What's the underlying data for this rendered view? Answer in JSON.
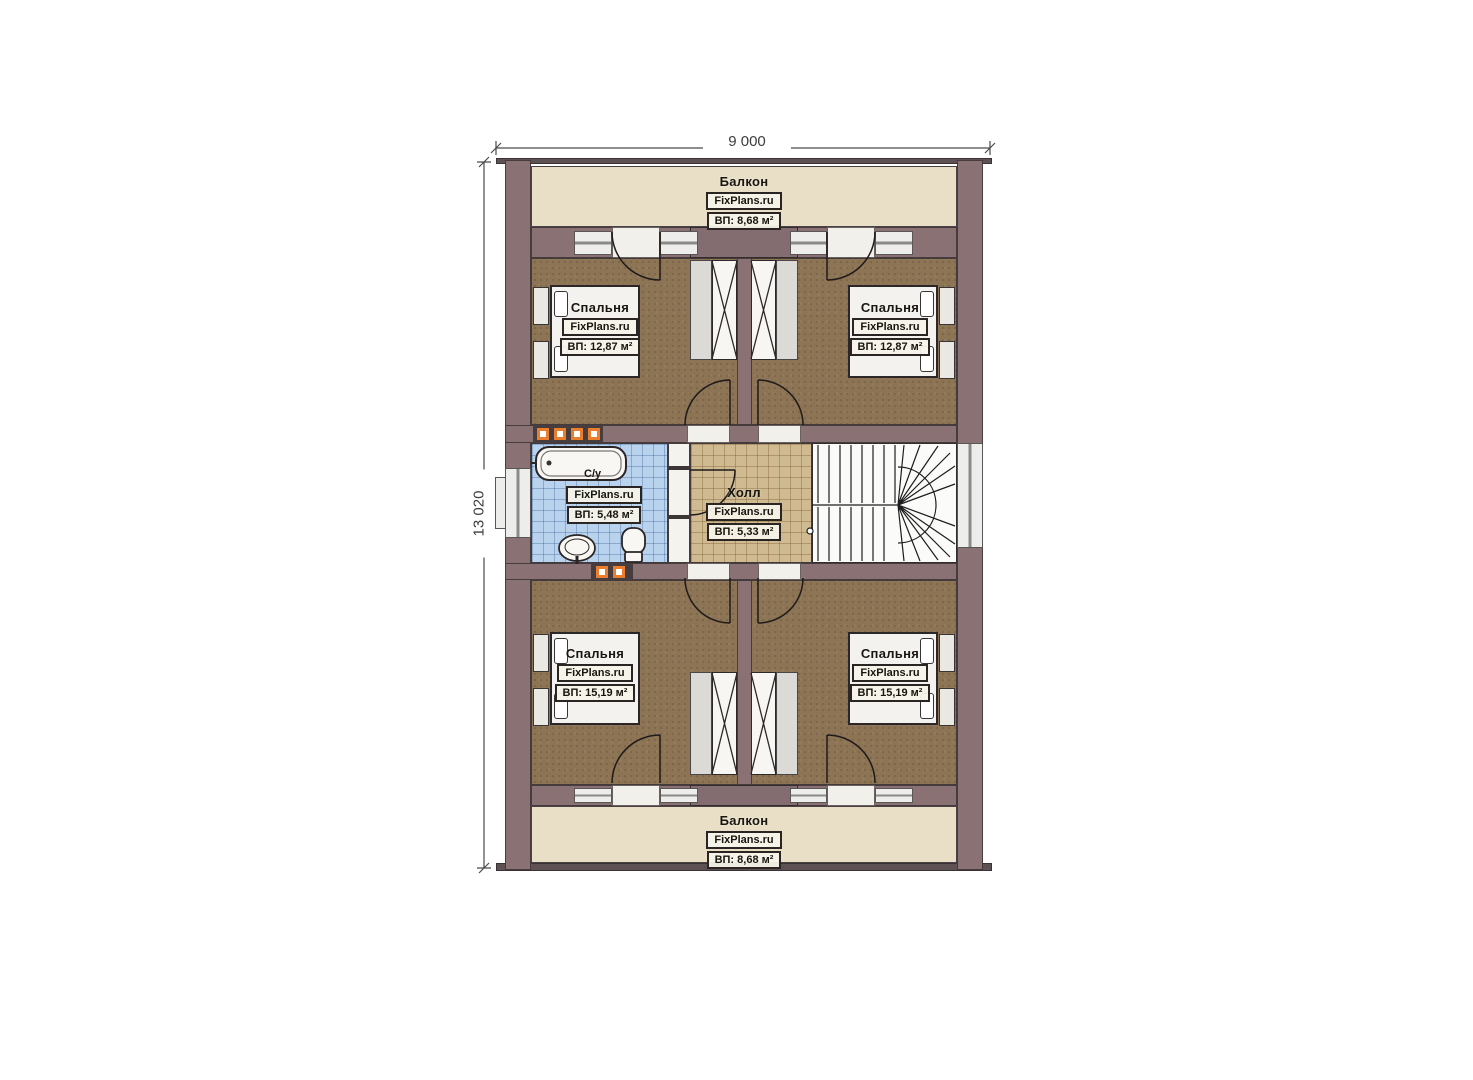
{
  "dimensions": {
    "width_label": "9 000",
    "height_label": "13 020"
  },
  "rooms": {
    "balcony_top": {
      "name": "Балкон",
      "brand": "FixPlans.ru",
      "area": "ВП: 8,68 м²"
    },
    "bedroom_top_left": {
      "name": "Спальня",
      "brand": "FixPlans.ru",
      "area": "ВП: 12,87 м²"
    },
    "bedroom_top_right": {
      "name": "Спальня",
      "brand": "FixPlans.ru",
      "area": "ВП: 12,87 м²"
    },
    "bathroom": {
      "name": "С/у",
      "brand": "FixPlans.ru",
      "area": "ВП: 5,48 м²"
    },
    "hall": {
      "name": "Холл",
      "brand": "FixPlans.ru",
      "area": "ВП: 5,33 м²"
    },
    "bedroom_bottom_left": {
      "name": "Спальня",
      "brand": "FixPlans.ru",
      "area": "ВП: 15,19 м²"
    },
    "bedroom_bottom_right": {
      "name": "Спальня",
      "brand": "FixPlans.ru",
      "area": "ВП: 15,19 м²"
    },
    "balcony_bottom": {
      "name": "Балкон",
      "brand": "FixPlans.ru",
      "area": "ВП: 8,68 м²"
    }
  },
  "colors": {
    "wall": "#897174",
    "bedroom_floor": "#8c7454",
    "balcony_floor": "#e8dfc6",
    "bathroom_floor": "#b9d3ef",
    "hall_floor": "#cfba92",
    "vent_accent": "#e97e2e"
  }
}
